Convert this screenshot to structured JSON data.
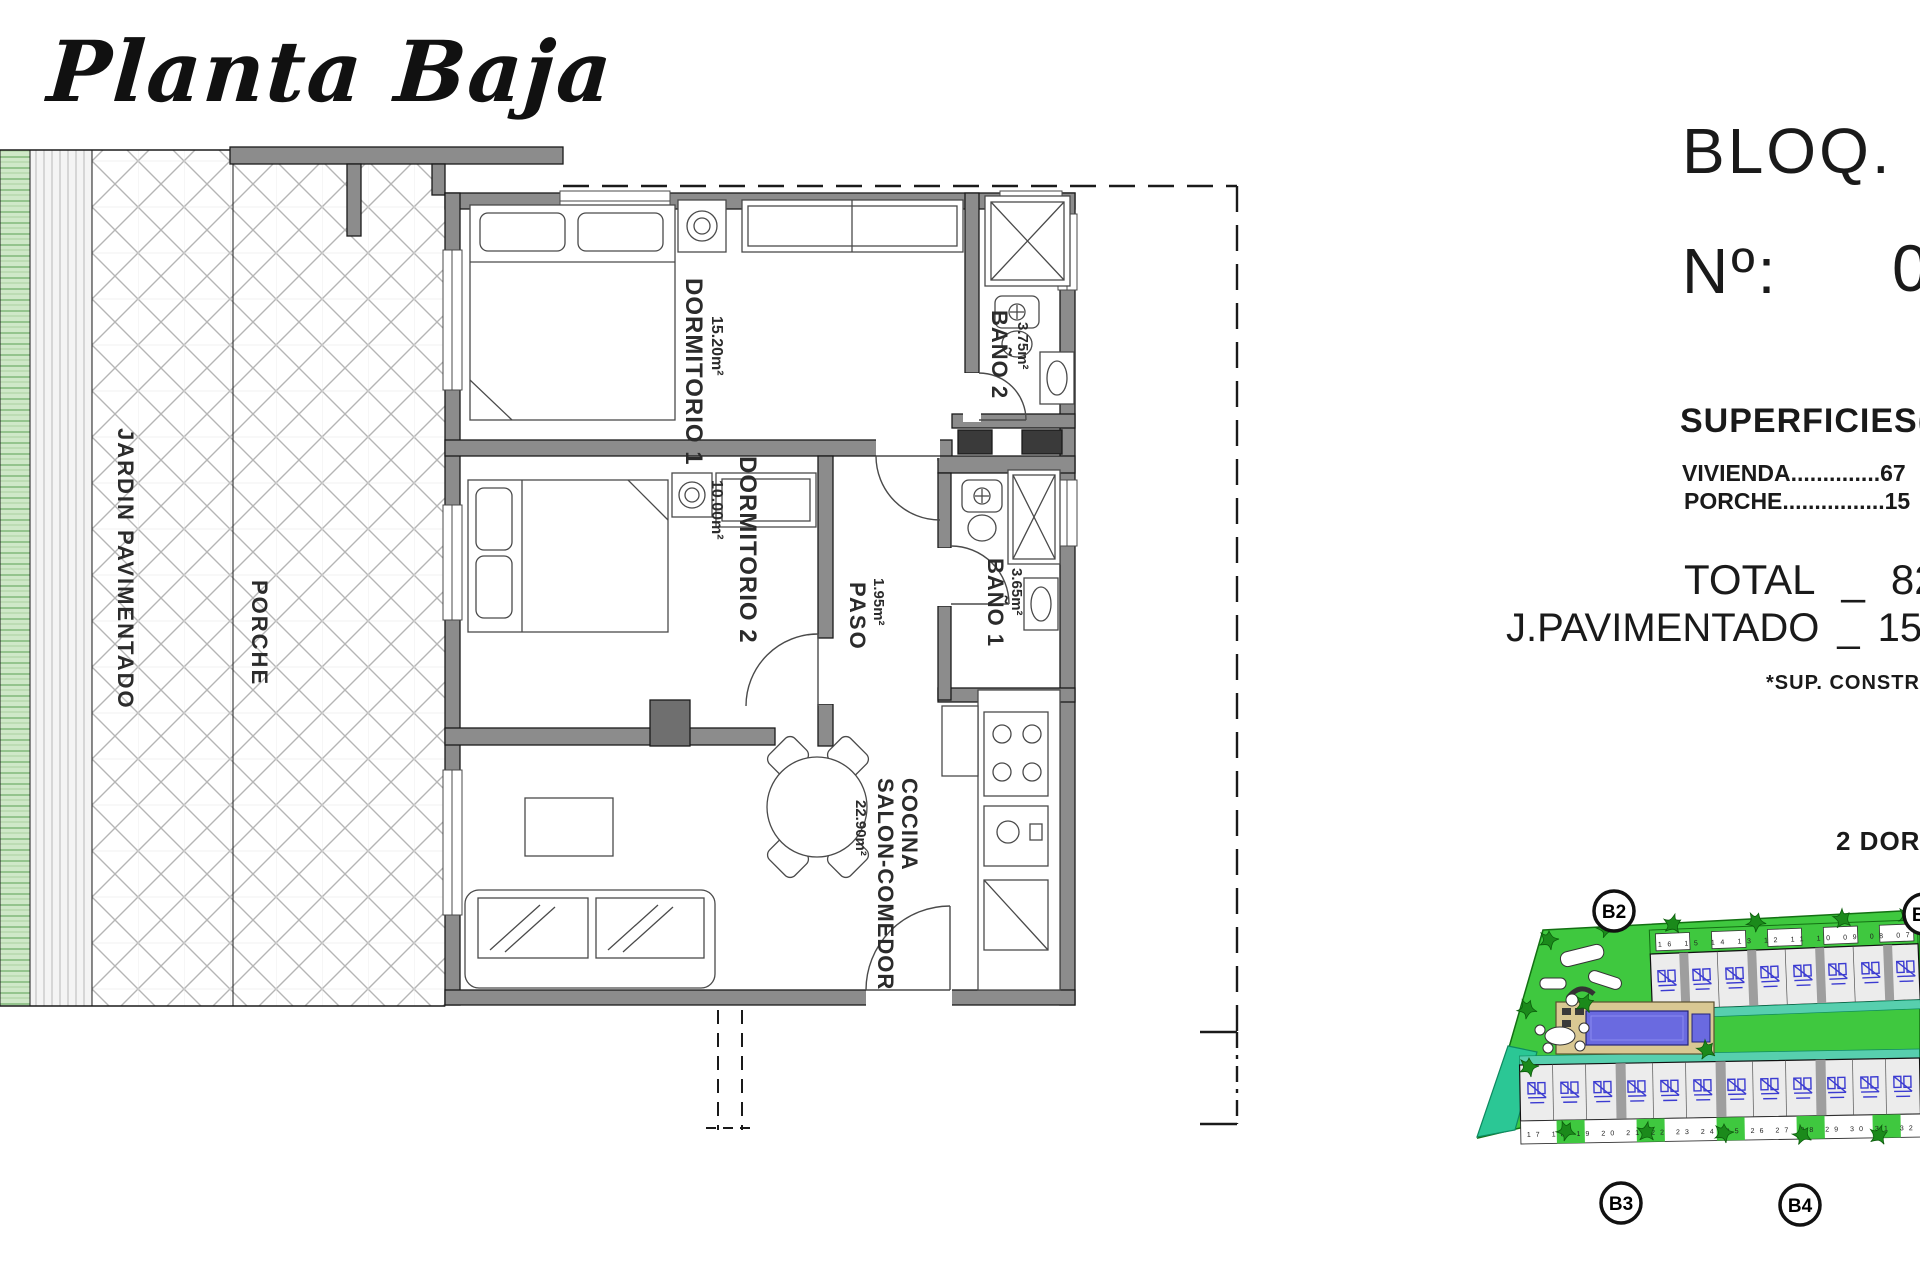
{
  "title": "Planta Baja",
  "plan": {
    "outdoor": {
      "jardin": "JARDIN PAVIMENTADO",
      "porche": "PORCHE"
    },
    "rooms": {
      "dormitorio1": {
        "name": "DORMITORIO 1",
        "area": "15.20m²"
      },
      "dormitorio2": {
        "name": "DORMITORIO 2",
        "area": "10.00m²"
      },
      "bano2": {
        "name": "BAÑO 2",
        "area": "3.75m²"
      },
      "bano1": {
        "name": "BAÑO 1",
        "area": "3.65m²"
      },
      "paso": {
        "name": "PASO",
        "area": "1.95m²"
      },
      "cocina": {
        "name_line1": "COCINA",
        "name_line2": "SALON-COMEDOR",
        "area": "22.90m²"
      }
    }
  },
  "info_panel": {
    "bloq_label": "BLOQ.",
    "numero_label": "Nº:",
    "numero_partial": "0",
    "superficies_heading": "SUPERFICIES(",
    "vivienda_line": "VIVIENDA..............67",
    "porche_line": "PORCHE................15",
    "total_label": "TOTAL",
    "total_separator": "_",
    "total_value": "82,",
    "jpavimentado_label": "J.PAVIMENTADO",
    "jpavimentado_separator": "_",
    "jpavimentado_value": "15,",
    "footnote": "*SUP. CONSTRU",
    "typology": "2 DORM"
  },
  "site_plan": {
    "badges": {
      "top": "B2",
      "top_right": "B5",
      "bottom_left": "B3",
      "bottom_right": "B4"
    },
    "top_row_numbers": "16 15  14 13  12 11  10 09  08 07",
    "bottom_row_numbers": "17 18  19 20  21 22  23 24  25 26  27 28  29 30  31 32",
    "colors": {
      "grass_green": "#3fc83f",
      "teal_green": "#2bc795",
      "pool_blue": "#6a6ae0",
      "deck_tan": "#d9c893",
      "unit_blue": "#3b3bd1",
      "wall_gray": "#8c8c8c"
    }
  }
}
